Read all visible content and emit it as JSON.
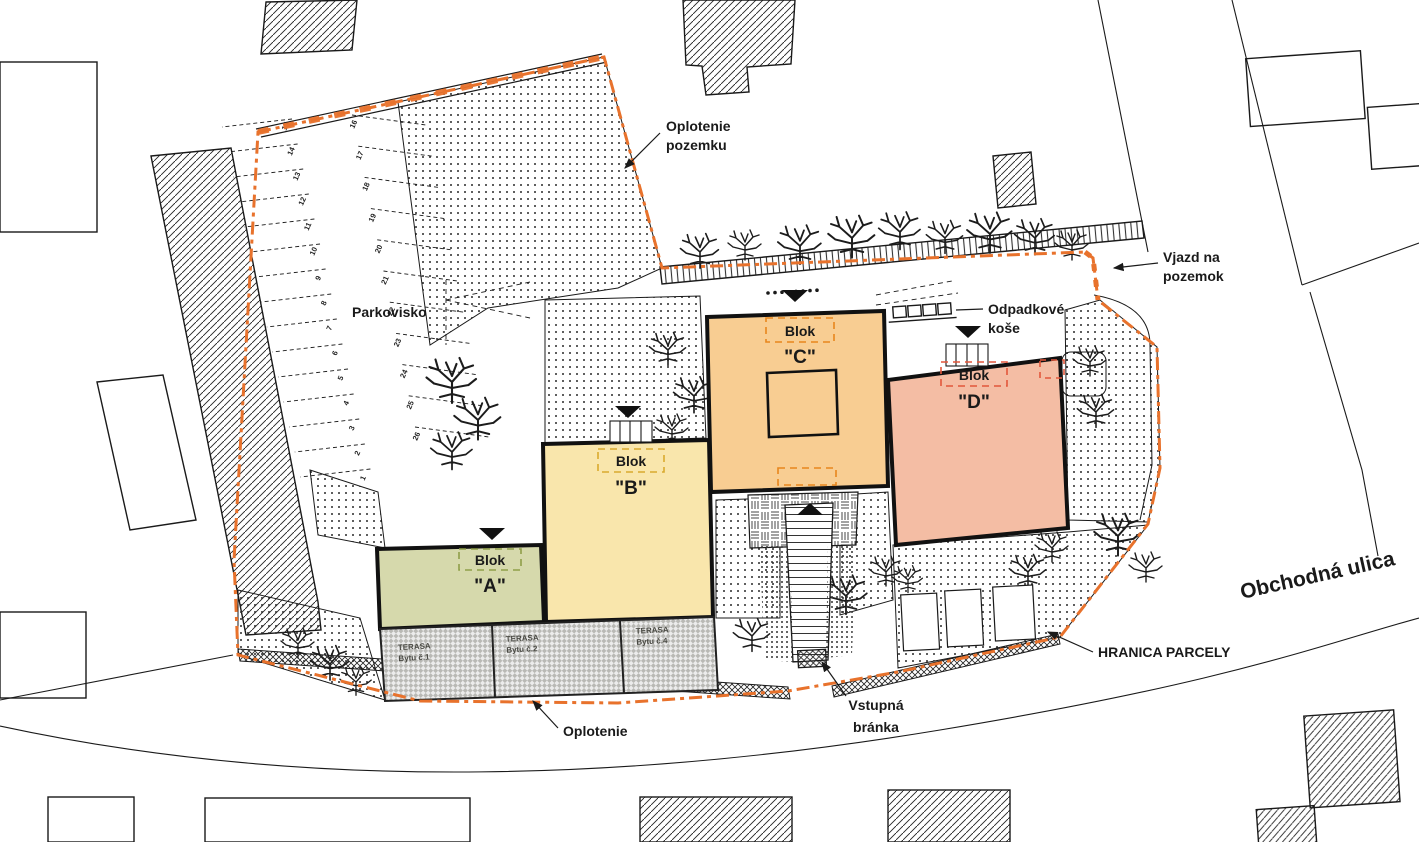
{
  "labels": {
    "oplotenie_pozemku": {
      "line1": "Oplotenie",
      "line2": "pozemku"
    },
    "vjazd": {
      "line1": "Vjazd na",
      "line2": "pozemok"
    },
    "odpadkove": {
      "line1": "Odpadkové",
      "line2": "koše"
    },
    "parkovisko": "Parkovisko",
    "obchodna_ulica": "Obchodná ulica",
    "hranica_parcely": "HRANICA PARCELY",
    "vstupna": {
      "line1": "Vstupná",
      "line2": "bránka"
    },
    "oplotenie": "Oplotenie"
  },
  "blocks": [
    {
      "id": "A",
      "tag": "Blok",
      "name": "\"A\"",
      "fill": "#d6d9ac",
      "dash": "#8f9f49"
    },
    {
      "id": "B",
      "tag": "Blok",
      "name": "\"B\"",
      "fill": "#f9e6ac",
      "dash": "#d9aa2e"
    },
    {
      "id": "C",
      "tag": "Blok",
      "name": "\"C\"",
      "fill": "#f8cd92",
      "dash": "#e8861d"
    },
    {
      "id": "D",
      "tag": "Blok",
      "name": "\"D\"",
      "fill": "#f4bda4",
      "dash": "#e2573b"
    }
  ],
  "terraces": [
    {
      "line1": "TERASA",
      "line2": "Bytu č.1"
    },
    {
      "line1": "TERASA",
      "line2": "Bytu č.2"
    },
    {
      "line1": "TERASA",
      "line2": "Bytu č.4"
    }
  ],
  "parking": {
    "left_numbers": [
      "15",
      "14",
      "13",
      "12",
      "11",
      "10",
      "9",
      "8",
      "7",
      "6",
      "5",
      "4",
      "3",
      "2",
      "1"
    ],
    "right_numbers": [
      "16",
      "17",
      "18",
      "19",
      "20",
      "21",
      "22",
      "23",
      "24",
      "25",
      "26"
    ]
  },
  "colors": {
    "boundary": "#e8722c",
    "line": "#1a1a1a"
  }
}
